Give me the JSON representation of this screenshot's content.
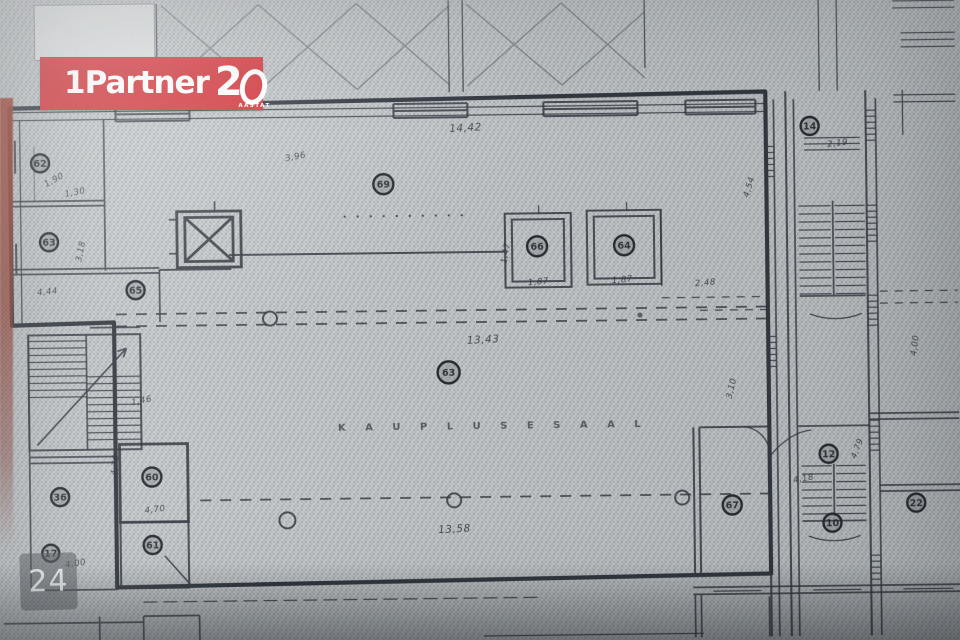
{
  "logo": {
    "brand": "1Partner",
    "anniversary_number": "20",
    "anniversary_label": "AASTAT",
    "background_color": "#d2343a",
    "text_color": "#ffffff"
  },
  "page_badge": {
    "number": "24"
  },
  "floor_plan": {
    "hall_label": "K A U P L U S E S A A L",
    "rooms": [
      {
        "number": "62"
      },
      {
        "number": "63"
      },
      {
        "number": "65"
      },
      {
        "number": "69"
      },
      {
        "number": "66"
      },
      {
        "number": "64"
      },
      {
        "number": "63"
      },
      {
        "number": "36"
      },
      {
        "number": "17"
      },
      {
        "number": "60"
      },
      {
        "number": "61"
      },
      {
        "number": "67"
      },
      {
        "number": "14"
      },
      {
        "number": "12"
      },
      {
        "number": "10"
      },
      {
        "number": "22"
      }
    ],
    "dims": {
      "d0": "14,42",
      "d1": "3,96",
      "d2": "1,90",
      "d3": "1,30",
      "d4": "3,18",
      "d5": "4,44",
      "d6": "1,46",
      "d7": "13,43",
      "d8": "13,58",
      "d9": "1,87",
      "d10": "1,87",
      "d11": "2,48",
      "d12": "1,47",
      "d13": "4,54",
      "d14": "3,10",
      "d15": "2,19",
      "d16": "4,18",
      "d17": "4,79",
      "d18": "4,76",
      "d19": "4,70",
      "d20": "4,00",
      "d21": "4,00"
    }
  },
  "colors": {
    "paper": "#ccd0d2",
    "ink": "#363b43",
    "boundary_highlight": "#20242c",
    "red_edge": "#9c4234"
  }
}
